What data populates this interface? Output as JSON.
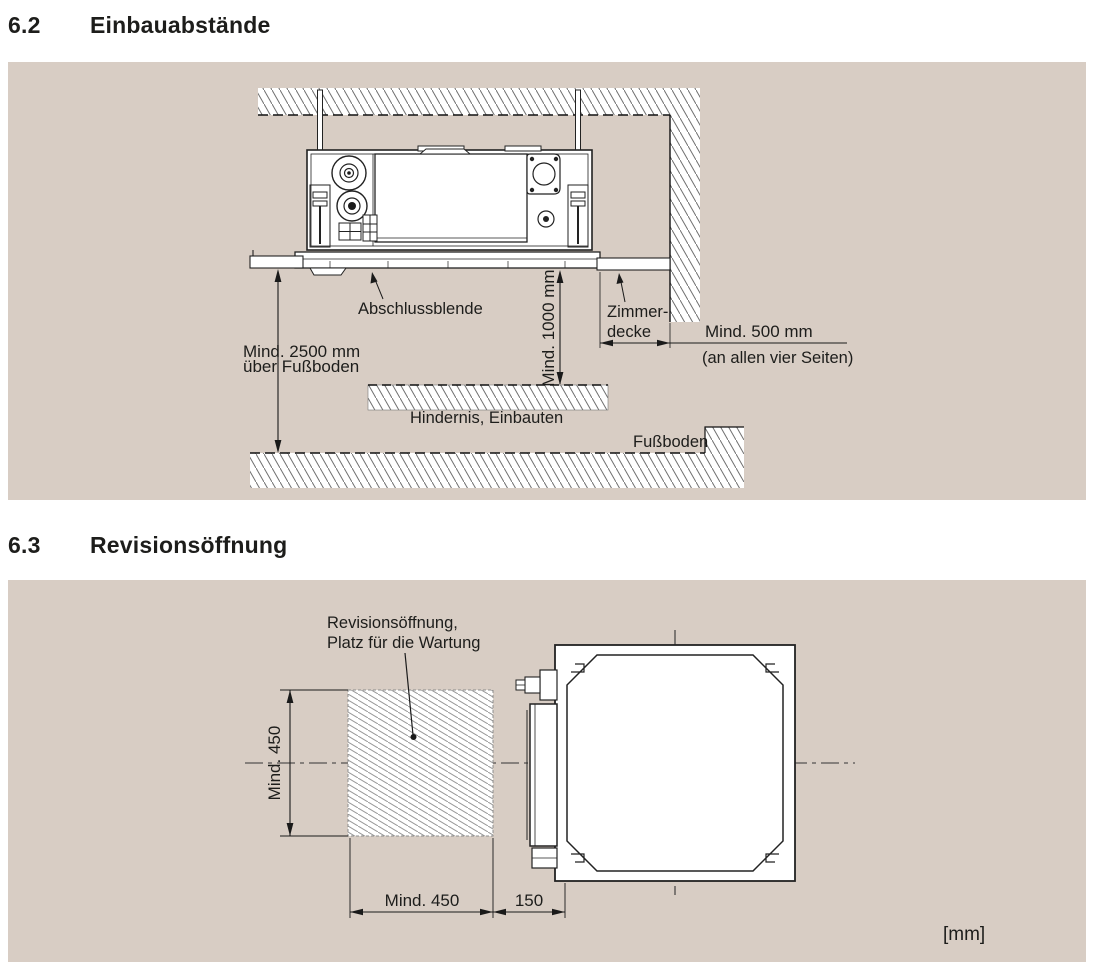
{
  "sections": [
    {
      "number": "6.2",
      "title": "Einbauabstände"
    },
    {
      "number": "6.3",
      "title": "Revisionsöffnung"
    }
  ],
  "colors": {
    "panel_bg": "#d8cdc4",
    "line": "#1d1d1b",
    "hatch": "#6f6f6f"
  },
  "d1": {
    "abschlussblende": "Abschlussblende",
    "mind2500a": "Mind. 2500 mm",
    "mind2500b": "über Fußboden",
    "mind1000": "Mind. 1000 mm",
    "zimmer1": "Zimmer-",
    "zimmer2": "decke",
    "mind500a": "Mind. 500 mm",
    "mind500b": "(an allen vier Seiten)",
    "hindernis": "Hindernis, Einbauten",
    "fussboden": "Fußboden"
  },
  "d2": {
    "rev1": "Revisionsöffnung,",
    "rev2": "Platz für die Wartung",
    "dimV": "Mind. 450",
    "dimH": "Mind. 450",
    "dim150": "150",
    "mm": "[mm]"
  }
}
